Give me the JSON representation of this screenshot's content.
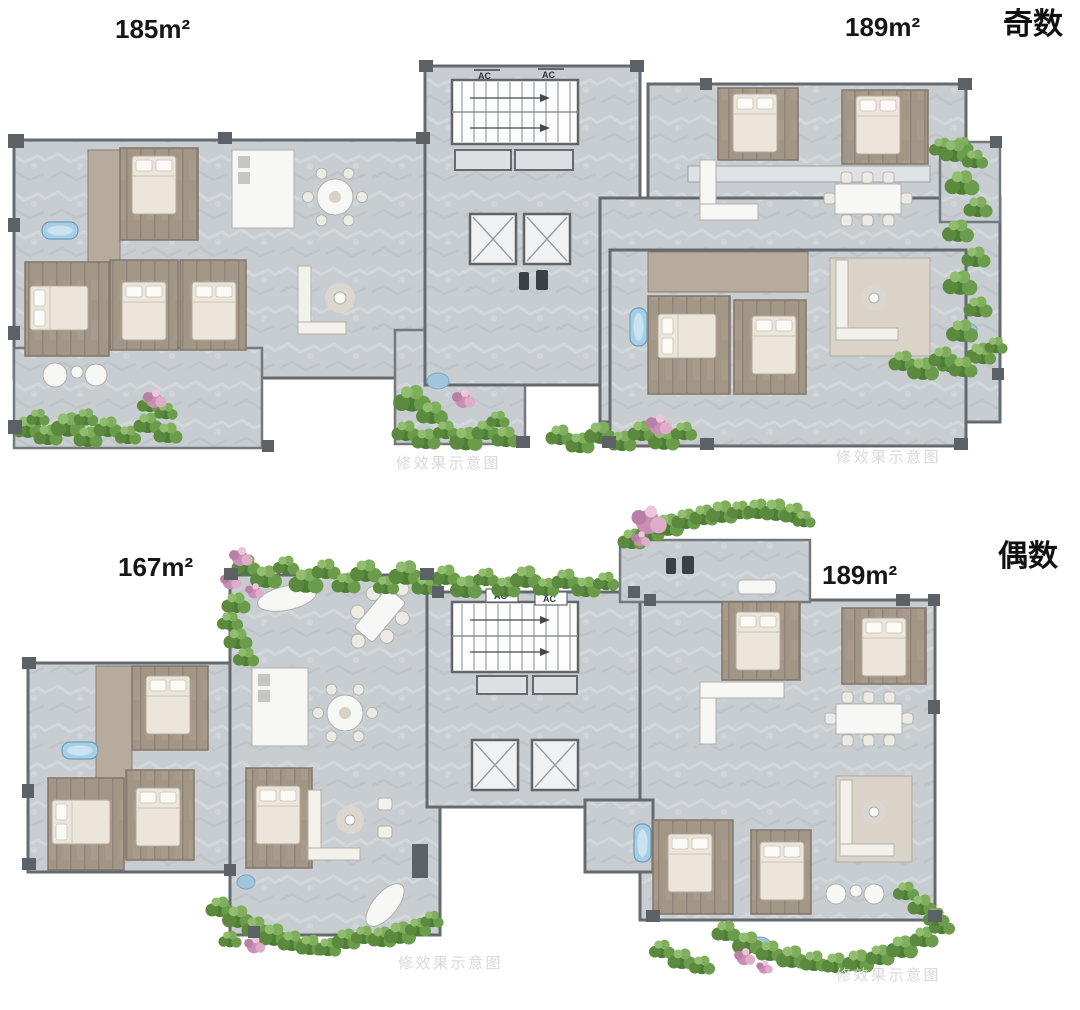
{
  "colors": {
    "background": "#ffffff",
    "floor_marble": "#c8cdd2",
    "wall": "#656a6e",
    "wood_floor": "#a29687",
    "pale_wood": "#d9d3c8",
    "greenery": "#5b8a3e",
    "flower_pink": "#c98fb4",
    "water_blue": "#a6cfe5",
    "label_text": "#161616",
    "watermark_gray": "#d9d9d9"
  },
  "plans": [
    {
      "parity_label": "奇数",
      "left_area": "185m²",
      "right_area": "189m²",
      "watermark": "修效果示意图",
      "ac_label": "AC"
    },
    {
      "parity_label": "偶数",
      "left_area": "167m²",
      "right_area": "189m²",
      "watermark": "修效果示意图",
      "ac_label": "AC"
    }
  ]
}
